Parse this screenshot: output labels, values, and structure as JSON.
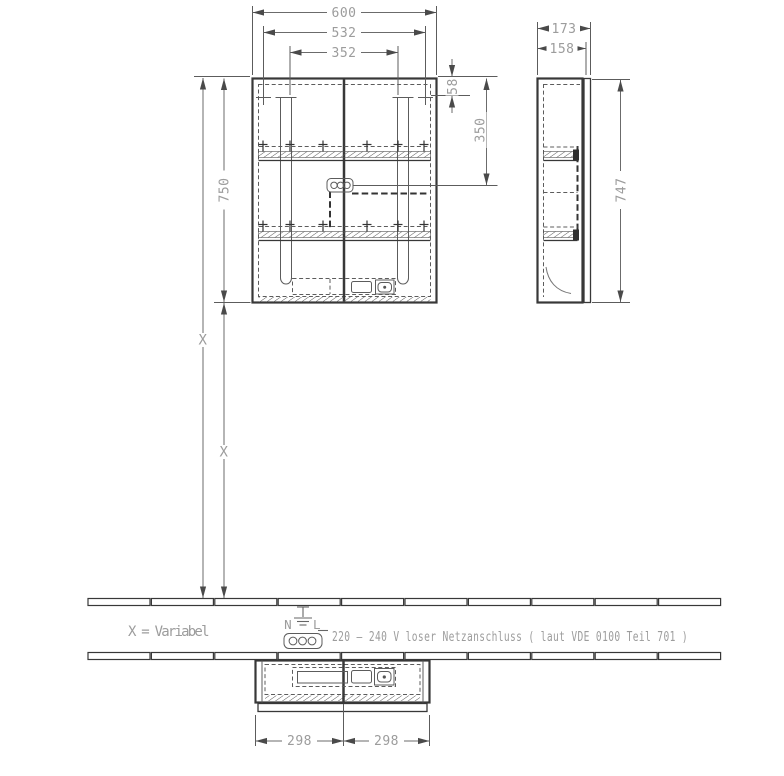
{
  "drawing": {
    "front": {
      "width": "600",
      "width_inner": "532",
      "width_lamps": "352",
      "height": "750",
      "top_offset": "58",
      "socket_drop": "350",
      "var_upper": "X",
      "var_lower": "X"
    },
    "side": {
      "depth": "173",
      "depth_body": "158",
      "height": "747"
    },
    "bottom": {
      "left_width": "298",
      "right_width": "298"
    },
    "notes": {
      "variable": "X = Variabel",
      "power": "220 – 240 V loser Netzanschluss ( laut VDE 0100 Teil 701 )",
      "terminal_n": "N",
      "terminal_l": "L"
    },
    "colors": {
      "line": "#383838",
      "dim_text": "#9c9c9c",
      "background": "#ffffff"
    }
  }
}
